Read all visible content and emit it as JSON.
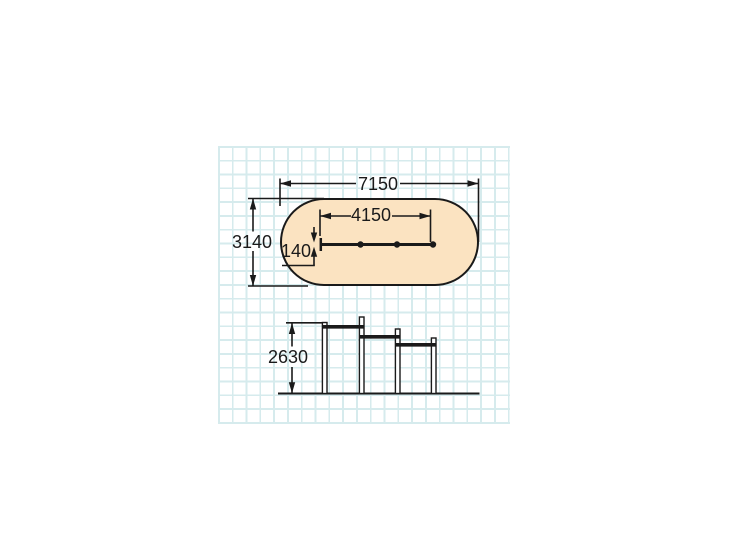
{
  "drawing": {
    "description": "dimension drawing of pull-up bar set with plan view and side elevation on grid paper",
    "plan_view": {
      "overall_length_mm": "7150",
      "overall_width_mm": "3140",
      "bar_row_span_mm": "4150",
      "beam_width_mm": "140"
    },
    "elevation_view": {
      "max_height_mm": "2630"
    },
    "colors": {
      "safety_area_fill": "#fbe3c1",
      "line": "#1a1a1a",
      "grid_line": "#d6ebed",
      "background": "#ffffff"
    }
  }
}
